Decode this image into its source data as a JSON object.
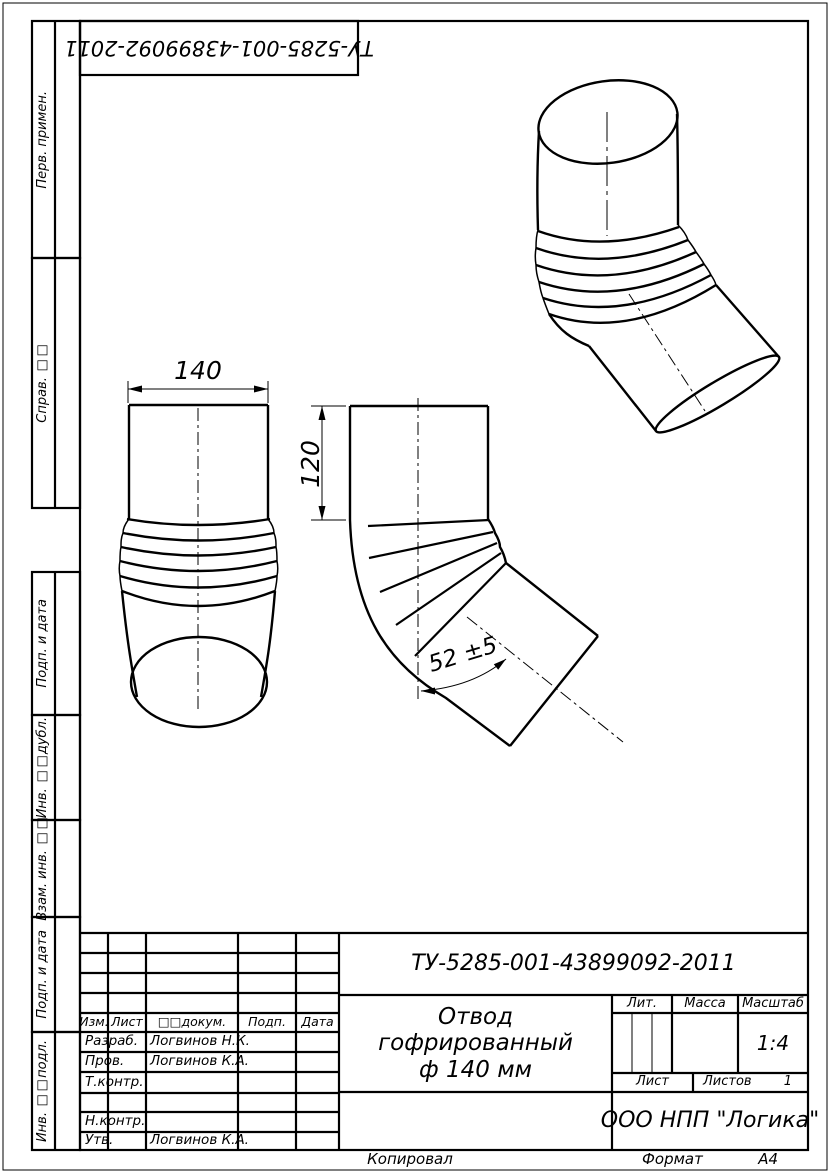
{
  "doc": {
    "number": "ТУ-5285-001-43899092-2011",
    "name_line1": "Отвод гофрированный",
    "name_line2": "ф 140 мм",
    "company": "ООО НПП \"Логика\"",
    "scale_value": "1:4",
    "sheets_value": "1",
    "format_value": "А4"
  },
  "labels": {
    "copied": "Копировал",
    "format": "Формат",
    "lit": "Лит.",
    "mass": "Масса",
    "scale": "Масштаб",
    "sheet": "Лист",
    "sheets": "Листов"
  },
  "revision_header": {
    "izm": "Изм.",
    "list": "Лист",
    "ndokum": "□□докум.",
    "podp": "Подп.",
    "data": "Дата"
  },
  "stamp_rows": [
    {
      "role": "Разраб.",
      "name": "Логвинов Н.К."
    },
    {
      "role": "Пров.",
      "name": "Логвинов К.А."
    },
    {
      "role": "Т.контр.",
      "name": ""
    },
    {
      "role": "",
      "name": ""
    },
    {
      "role": "Н.контр.",
      "name": ""
    },
    {
      "role": "Утв.",
      "name": "Логвинов К.А."
    }
  ],
  "sidebar_items": [
    {
      "label": "Перв. примен."
    },
    {
      "label": "Справ. □□"
    },
    {
      "label": "Подп. и дата"
    },
    {
      "label": "Инв. □□дубл."
    },
    {
      "label": "Взам. инв. □□"
    },
    {
      "label": "Подп. и дата"
    },
    {
      "label": "Инв. □□подл."
    }
  ],
  "dimensions": {
    "width": "140",
    "height": "120",
    "angle": "52 ±5"
  }
}
